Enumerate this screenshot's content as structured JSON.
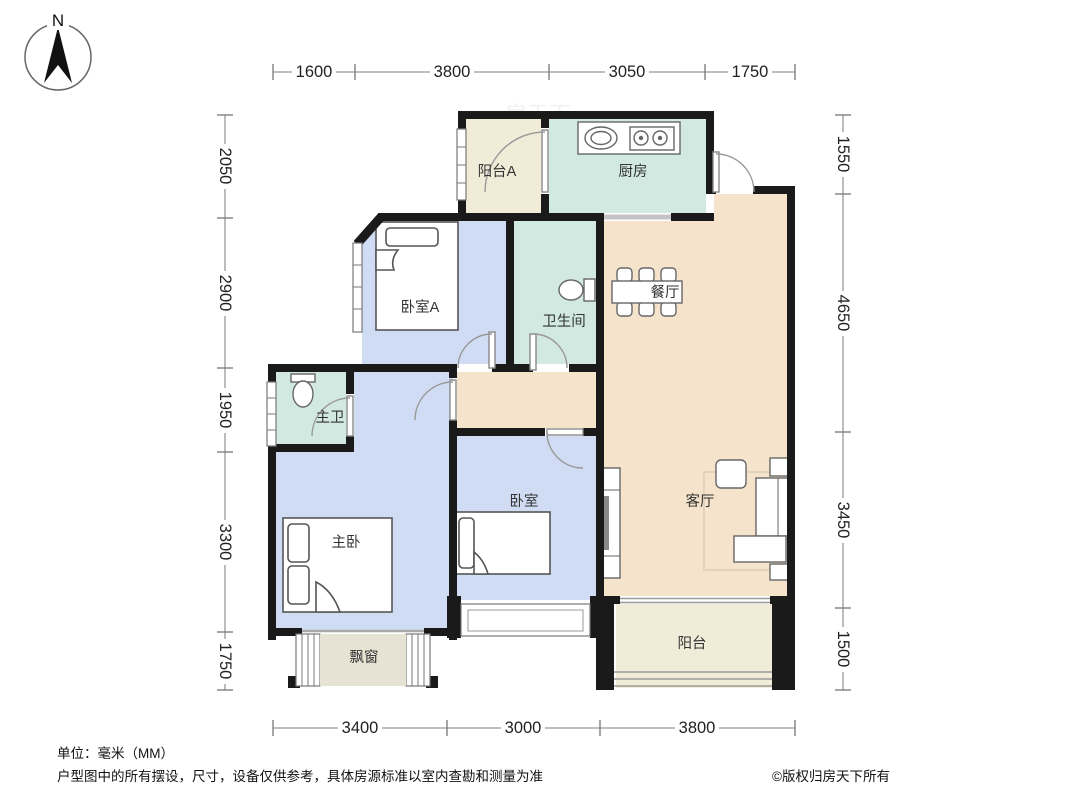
{
  "compass": {
    "north_label": "N"
  },
  "watermark": "房天下",
  "rooms": {
    "balcony_a": {
      "label": "阳台A"
    },
    "kitchen": {
      "label": "厨房"
    },
    "bedroom_a": {
      "label": "卧室A"
    },
    "bathroom": {
      "label": "卫生间"
    },
    "dining": {
      "label": "餐厅"
    },
    "master_bathroom": {
      "label": "主卫"
    },
    "master_bedroom": {
      "label": "主卧"
    },
    "bedroom": {
      "label": "卧室"
    },
    "living": {
      "label": "客厅"
    },
    "bay_window": {
      "label": "飘窗"
    },
    "balcony": {
      "label": "阳台"
    }
  },
  "dimensions": {
    "unit": "mm",
    "top": [
      "1600",
      "3800",
      "3050",
      "1750"
    ],
    "bottom": [
      "3400",
      "3000",
      "3800"
    ],
    "left": [
      "2050",
      "2900",
      "1950",
      "3300",
      "1750"
    ],
    "right": [
      "1550",
      "4650",
      "3450",
      "1500"
    ]
  },
  "footer": {
    "unit": "单位：毫米（MM）",
    "disclaimer": "户型图中的所有摆设，尺寸，设备仅供参考，具体房源标准以室内查勘和测量为准",
    "copyright": "©版权归房天下所有"
  },
  "colors": {
    "wall": "#1a1a1a",
    "room_bedroom": "#cfdcf3",
    "room_wet": "#d2e9e1",
    "room_public": "#f6e3cb",
    "room_balcony": "#f0ecd8",
    "room_bay": "#e6e3d4"
  }
}
